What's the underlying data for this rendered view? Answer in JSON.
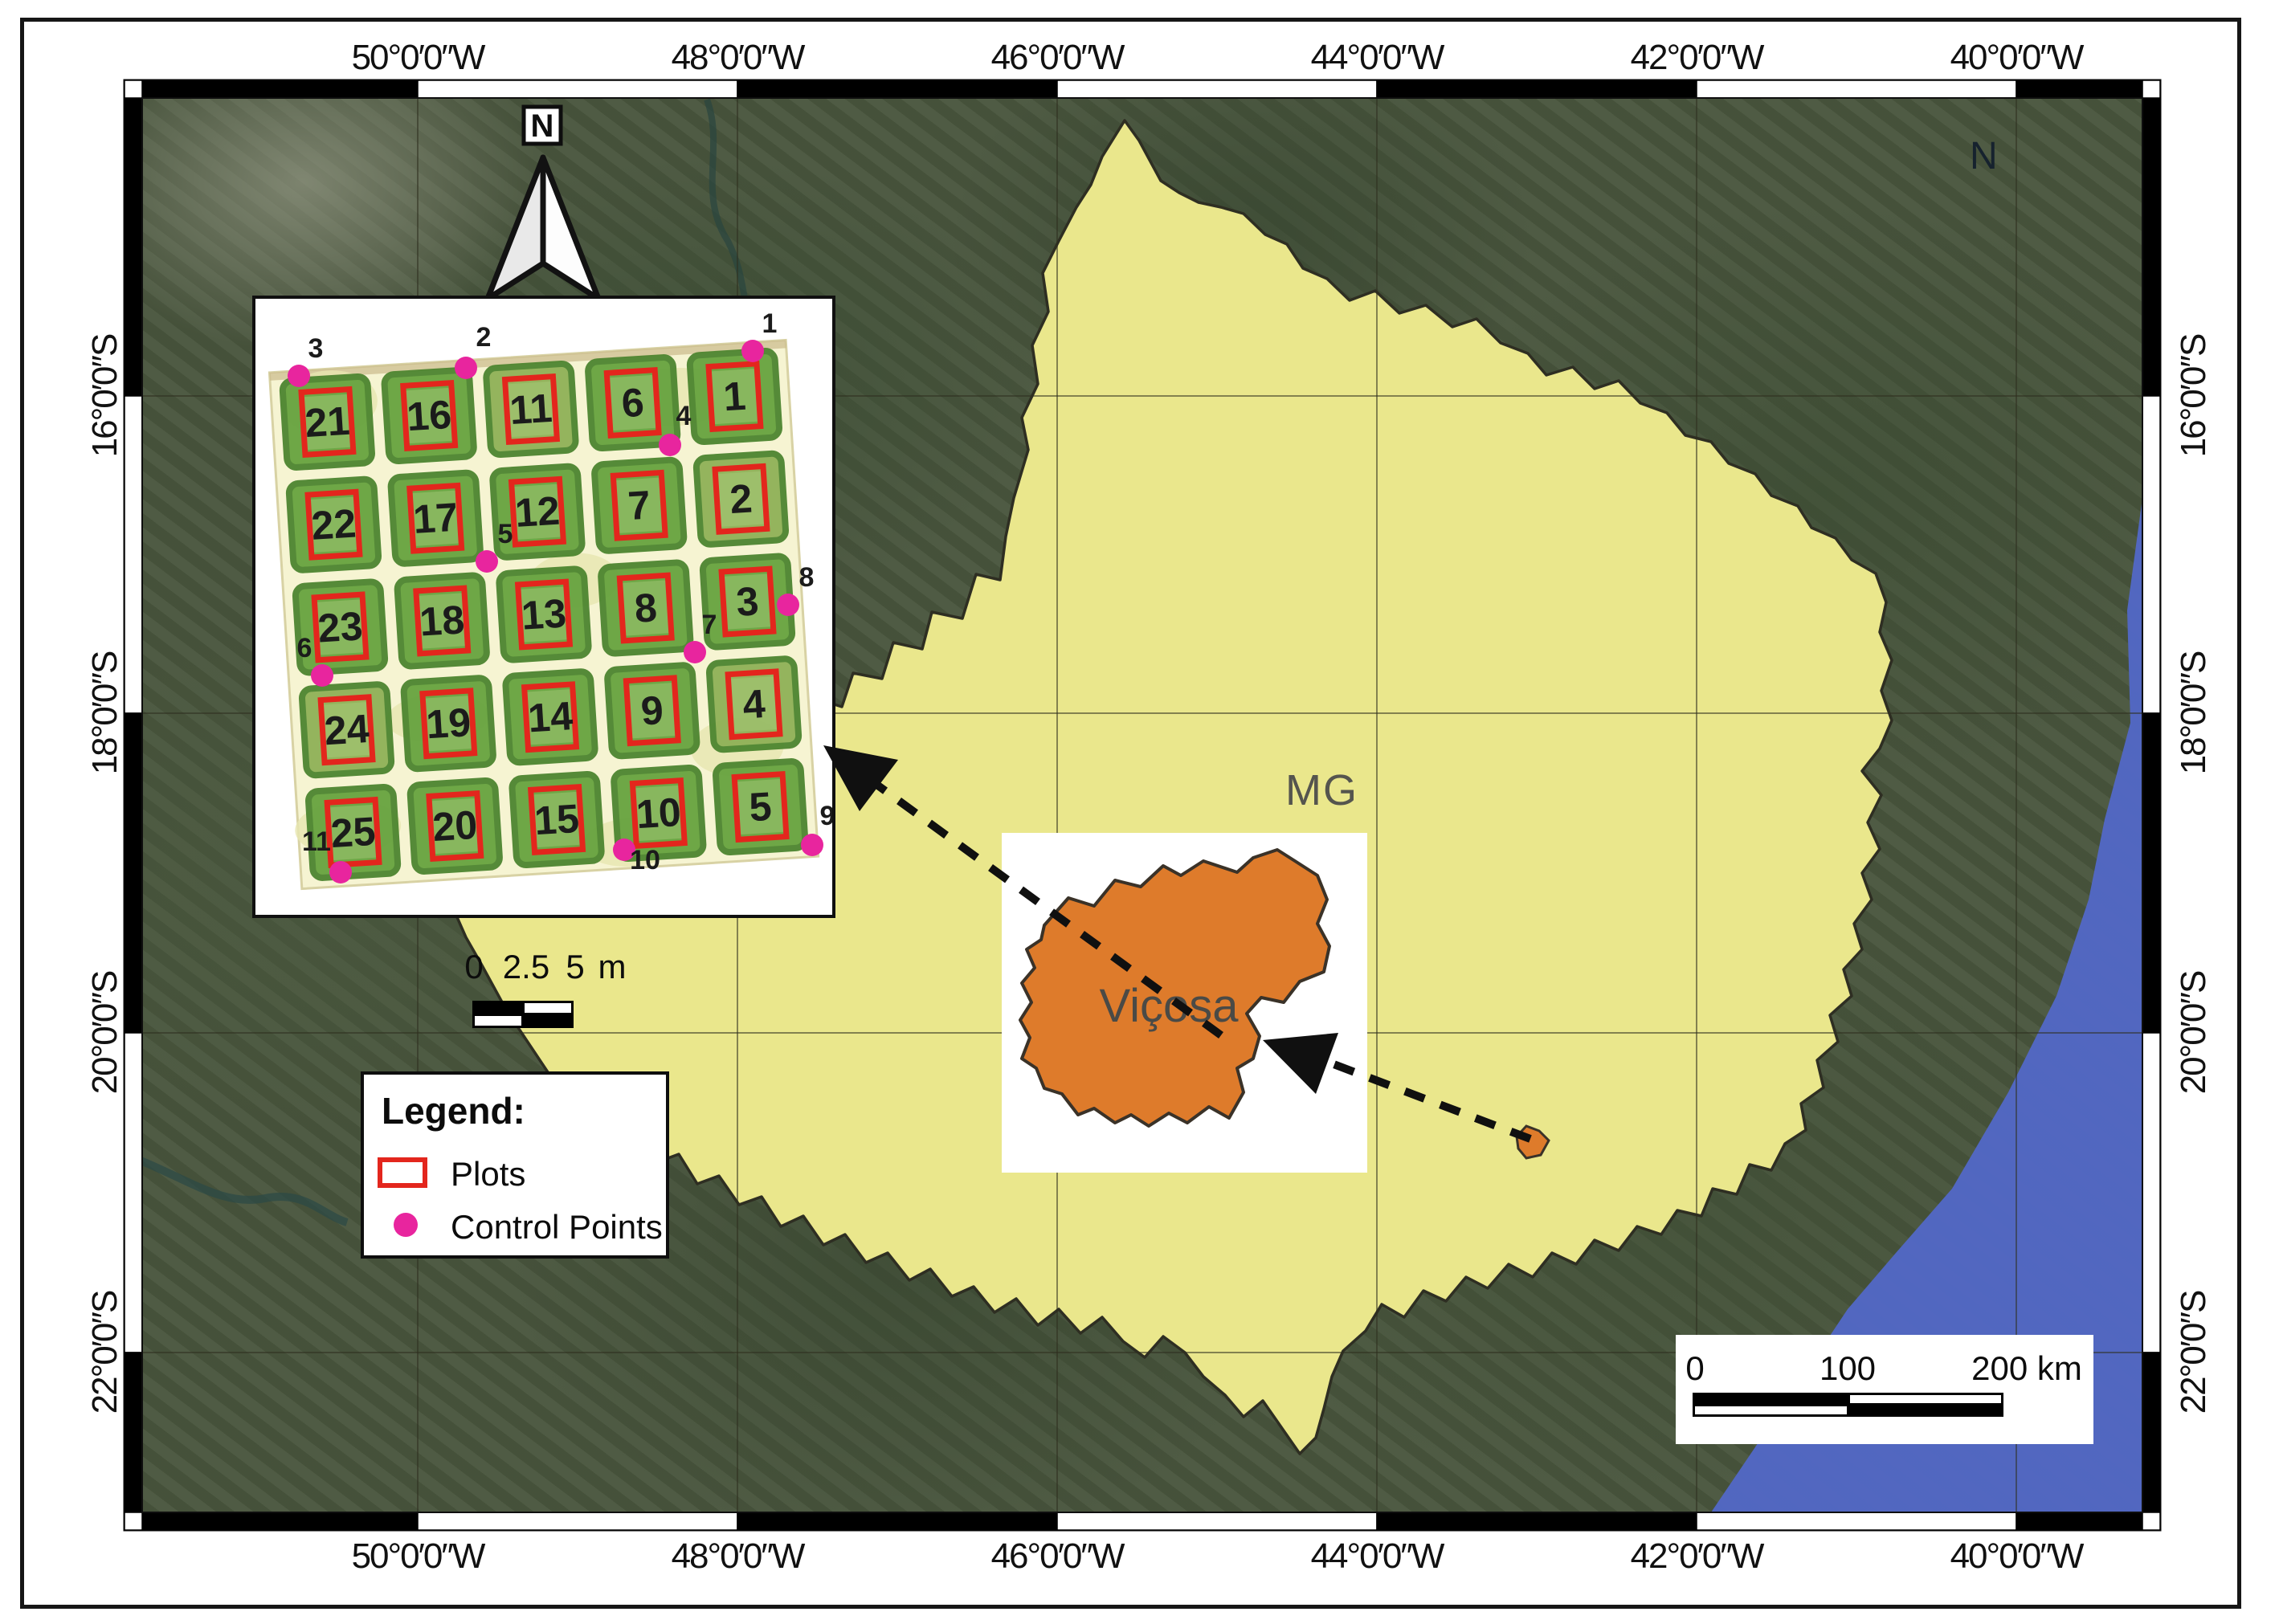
{
  "map": {
    "region_label": "MG",
    "stray_letter": "N",
    "north_arrow_label": "N"
  },
  "graticule": {
    "top": [
      "50°0′0″W",
      "48°0′0″W",
      "46°0′0″W",
      "44°0′0″W",
      "42°0′0″W",
      "40°0′0″W"
    ],
    "bottom": [
      "50°0′0″W",
      "48°0′0″W",
      "46°0′0″W",
      "44°0′0″W",
      "42°0′0″W",
      "40°0′0″W"
    ],
    "left": [
      "16°0′0″S",
      "18°0′0″S",
      "20°0′0″S",
      "22°0′0″S"
    ],
    "right": [
      "16°0′0″S",
      "18°0′0″S",
      "20°0′0″S",
      "22°0′0″S"
    ]
  },
  "plots_inset": {
    "plot_rows": [
      [
        21,
        16,
        11,
        6,
        1
      ],
      [
        22,
        17,
        12,
        7,
        2
      ],
      [
        23,
        18,
        13,
        8,
        3
      ],
      [
        24,
        19,
        14,
        9,
        4
      ],
      [
        25,
        20,
        15,
        10,
        5
      ]
    ],
    "control_points": [
      {
        "n": "1",
        "dot": [
          937,
          437
        ],
        "label": [
          958,
          414
        ]
      },
      {
        "n": "2",
        "dot": [
          580,
          458
        ],
        "label": [
          602,
          431
        ]
      },
      {
        "n": "3",
        "dot": [
          372,
          468
        ],
        "label": [
          393,
          445
        ]
      },
      {
        "n": "4",
        "dot": [
          834,
          554
        ],
        "label": [
          851,
          529
        ]
      },
      {
        "n": "5",
        "dot": [
          606,
          699
        ],
        "label": [
          629,
          676
        ]
      },
      {
        "n": "6",
        "dot": [
          401,
          841
        ],
        "label": [
          379,
          818
        ]
      },
      {
        "n": "7",
        "dot": [
          865,
          812
        ],
        "label": [
          883,
          789
        ]
      },
      {
        "n": "8",
        "dot": [
          981,
          753
        ],
        "label": [
          1004,
          730
        ]
      },
      {
        "n": "9",
        "dot": [
          1011,
          1052
        ],
        "label": [
          1030,
          1027
        ]
      },
      {
        "n": "10",
        "dot": [
          777,
          1058
        ],
        "label": [
          803,
          1082
        ]
      },
      {
        "n": "11",
        "dot": [
          424,
          1086
        ],
        "label": [
          394,
          1059
        ]
      }
    ],
    "scalebar": {
      "labels": [
        "0",
        "2.5",
        "5",
        "m"
      ]
    }
  },
  "vicosa_inset": {
    "label": "Viçosa"
  },
  "legend": {
    "title": "Legend:",
    "items": [
      {
        "label": "Plots"
      },
      {
        "label": "Control Points"
      }
    ]
  },
  "main_scalebar": {
    "labels": [
      "0",
      "100",
      "200 km"
    ]
  },
  "colors": {
    "state_fill": "#EAE78C",
    "municipality_fill": "#DE7B2B",
    "plot_outline": "#E3261D",
    "control_point": "#E8259E",
    "ocean": "#5268C6"
  }
}
